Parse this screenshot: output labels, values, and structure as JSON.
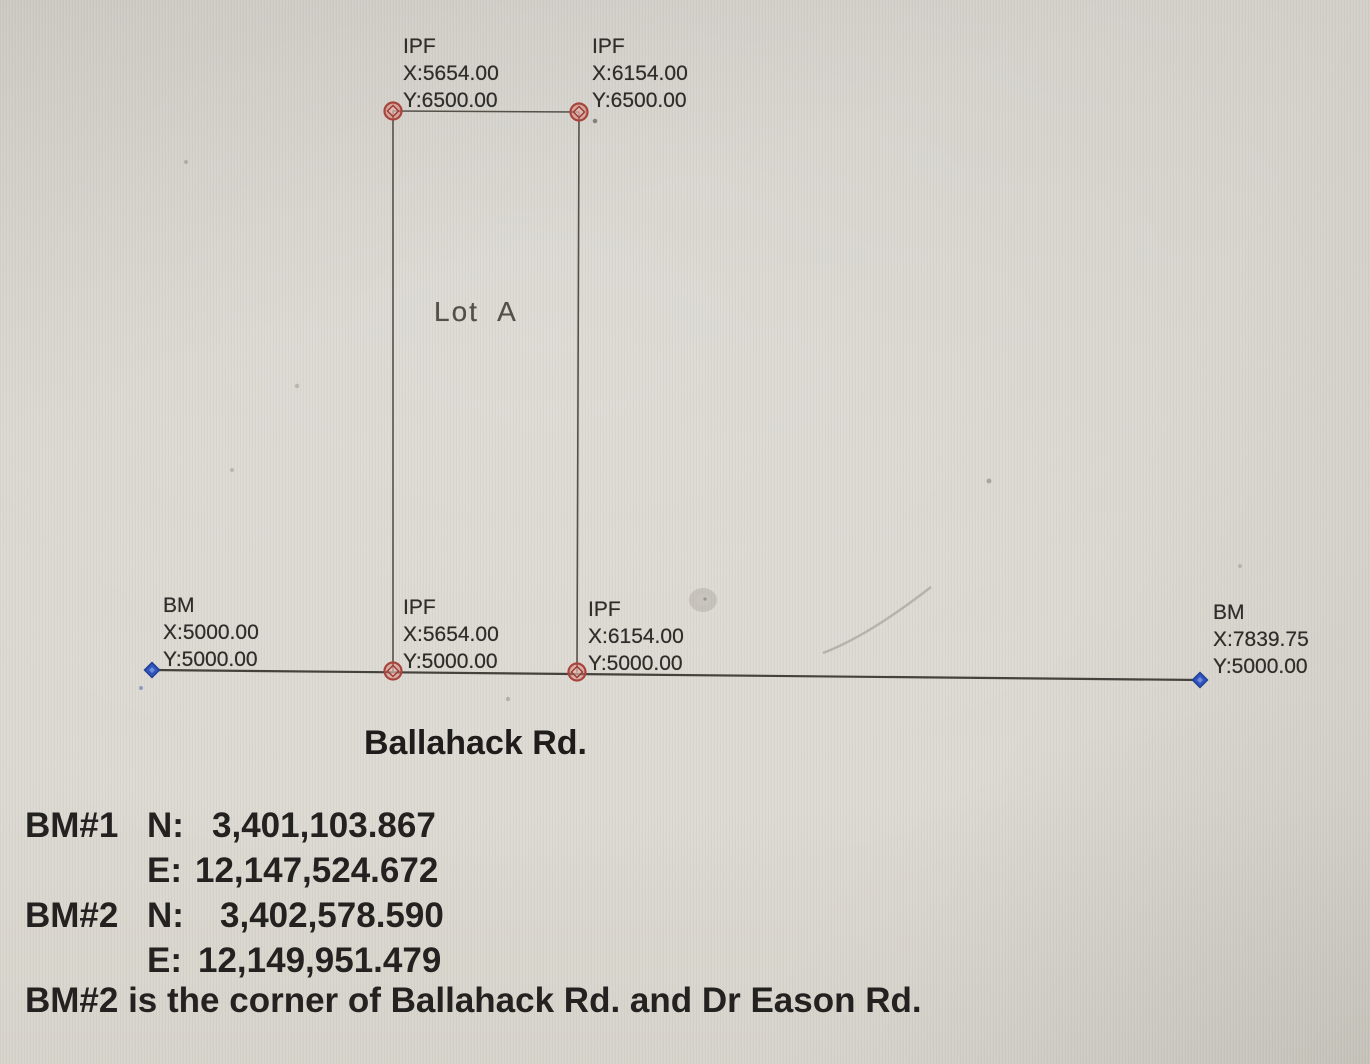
{
  "lot_label": "Lot A",
  "road_label": "Ballahack Rd.",
  "points": [
    {
      "id": "ipf-northwest",
      "type": "IPF",
      "x": "X:5654.00",
      "y": "Y:6500.00",
      "marker": "red-circle-diamond-marker"
    },
    {
      "id": "ipf-northeast",
      "type": "IPF",
      "x": "X:6154.00",
      "y": "Y:6500.00",
      "marker": "red-circle-diamond-marker"
    },
    {
      "id": "bm-west",
      "type": "BM",
      "x": "X:5000.00",
      "y": "Y:5000.00",
      "marker": "blue-diamond-marker"
    },
    {
      "id": "ipf-southwest",
      "type": "IPF",
      "x": "X:5654.00",
      "y": "Y:5000.00",
      "marker": "red-circle-diamond-marker"
    },
    {
      "id": "ipf-southeast",
      "type": "IPF",
      "x": "X:6154.00",
      "y": "Y:5000.00",
      "marker": "red-circle-diamond-marker"
    },
    {
      "id": "bm-east",
      "type": "BM",
      "x": "X:7839.75",
      "y": "Y:5000.00",
      "marker": "blue-diamond-marker"
    }
  ],
  "notes": [
    {
      "tag": "BM#1",
      "axis": "N:",
      "value": "3,401,103.867"
    },
    {
      "tag": "",
      "axis": "E:",
      "value": "12,147,524.672"
    },
    {
      "tag": "BM#2",
      "axis": "N:",
      "value": "3,402,578.590"
    },
    {
      "tag": "",
      "axis": "E:",
      "value": "12,149,951.479"
    }
  ],
  "footnote": "BM#2 is the corner of Ballahack Rd. and Dr Eason Rd.",
  "colors": {
    "paper": "#d8d5ce",
    "ink": "#232220",
    "boundary_line": "#55504a",
    "road_line": "#45423d",
    "marker_red_stroke": "#a8443c",
    "marker_red_fill": "#d57d72",
    "marker_blue": "#3056bd"
  }
}
